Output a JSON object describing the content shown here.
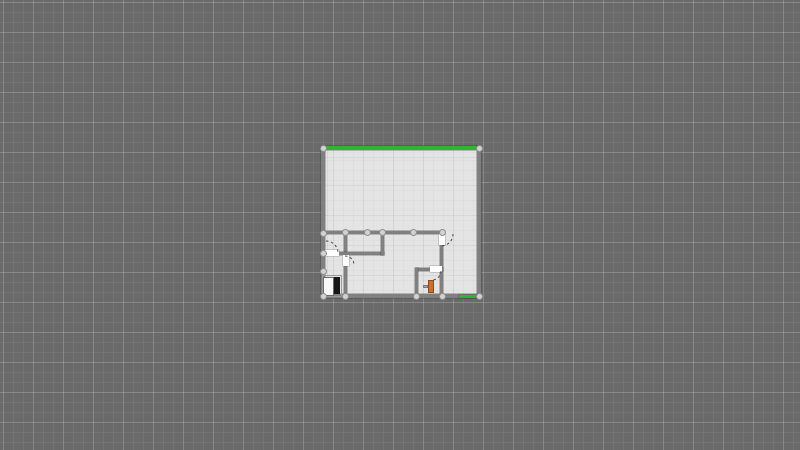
{
  "app": {
    "type": "floor-plan-editor-canvas",
    "visible_text": []
  },
  "colors": {
    "canvas_bg": "#6a6a6a",
    "floor": "#e4e4e4",
    "wall": "#808080",
    "selected_wall": "#2fb52f",
    "door": "#ffffff",
    "handle_fill": "#d2d2d2",
    "handle_edge": "#8f8f8f",
    "arc_stroke": "#4a4a4a",
    "furniture_black": "#161616",
    "furniture_white": "#f8f8f8",
    "furniture_orange": "#c5732c",
    "furniture_orange_edge": "#8a4a1a",
    "furniture_gray": "#a5a5a5"
  },
  "plan": {
    "floor": {
      "name": "room-floor",
      "x": 323,
      "y": 148,
      "w": 156,
      "h": 148
    },
    "walls": [
      {
        "name": "wall-top-selected",
        "x": 322,
        "y": 146,
        "w": 157,
        "h": 4,
        "color": "green"
      },
      {
        "name": "wall-left",
        "x": 321,
        "y": 146,
        "w": 4,
        "h": 152,
        "color": "gray"
      },
      {
        "name": "wall-right",
        "x": 477,
        "y": 146,
        "w": 4,
        "h": 152,
        "color": "gray"
      },
      {
        "name": "wall-bottom",
        "x": 321,
        "y": 294,
        "w": 158,
        "h": 4,
        "color": "gray"
      },
      {
        "name": "wall-bottom-right-selected",
        "x": 459,
        "y": 295,
        "w": 20,
        "h": 3,
        "color": "green"
      },
      {
        "name": "wall-middle-horizontal",
        "x": 323,
        "y": 231,
        "w": 120,
        "h": 3,
        "color": "gray"
      },
      {
        "name": "wall-vertical-left-rooms",
        "x": 344,
        "y": 231,
        "w": 3,
        "h": 66,
        "color": "gray"
      },
      {
        "name": "wall-horizontal-left-rooms",
        "x": 323,
        "y": 252,
        "w": 61,
        "h": 3,
        "color": "gray"
      },
      {
        "name": "wall-vertical-closet",
        "x": 381,
        "y": 231,
        "w": 3,
        "h": 24,
        "color": "gray"
      },
      {
        "name": "wall-vertical-right-room",
        "x": 440,
        "y": 231,
        "w": 3,
        "h": 66,
        "color": "gray"
      },
      {
        "name": "wall-bottom-room-top",
        "x": 416,
        "y": 268,
        "w": 27,
        "h": 3,
        "color": "gray"
      },
      {
        "name": "wall-bottom-room-left",
        "x": 415,
        "y": 268,
        "w": 3,
        "h": 29,
        "color": "gray"
      }
    ],
    "doors": [
      {
        "name": "door-opening-left-room",
        "x": 325,
        "y": 250,
        "w": 14,
        "h": 6
      },
      {
        "name": "door-opening-lower-left",
        "x": 343,
        "y": 255,
        "w": 6,
        "h": 11
      },
      {
        "name": "door-opening-hall",
        "x": 439,
        "y": 234,
        "w": 6,
        "h": 11
      },
      {
        "name": "door-opening-bottom-room",
        "x": 430,
        "y": 266,
        "w": 12,
        "h": 6
      }
    ],
    "door_arcs": [
      {
        "name": "door-swing-arc",
        "x1": 326,
        "y1": 241,
        "x2": 338,
        "y2": 253,
        "r": 12
      },
      {
        "name": "door-swing-arc",
        "x1": 345,
        "y1": 256,
        "x2": 354,
        "y2": 265,
        "r": 9
      },
      {
        "name": "door-swing-arc",
        "x1": 453,
        "y1": 234,
        "x2": 441,
        "y2": 246,
        "r": 12
      },
      {
        "name": "door-swing-arc",
        "x1": 441,
        "y1": 271,
        "x2": 432,
        "y2": 280,
        "r": 9
      }
    ],
    "handles": [
      {
        "x": 323,
        "y": 148
      },
      {
        "x": 479,
        "y": 148
      },
      {
        "x": 323,
        "y": 233
      },
      {
        "x": 323,
        "y": 253
      },
      {
        "x": 323,
        "y": 271
      },
      {
        "x": 323,
        "y": 296
      },
      {
        "x": 345,
        "y": 232
      },
      {
        "x": 367,
        "y": 232
      },
      {
        "x": 382,
        "y": 232
      },
      {
        "x": 413,
        "y": 232
      },
      {
        "x": 442,
        "y": 232
      },
      {
        "x": 345,
        "y": 296
      },
      {
        "x": 416,
        "y": 296
      },
      {
        "x": 442,
        "y": 296
      },
      {
        "x": 479,
        "y": 296
      }
    ],
    "furniture": [
      {
        "name": "furniture-cabinet-outline",
        "x": 322,
        "y": 275,
        "w": 20,
        "h": 22,
        "fill": "none",
        "edge": "#9a9a9a"
      },
      {
        "name": "furniture-cabinet-white-door",
        "x": 323,
        "y": 277,
        "w": 11,
        "h": 19,
        "fill": "#f8f8f8",
        "edge": "#6b6b6b"
      },
      {
        "name": "furniture-cabinet-black-panel",
        "x": 334,
        "y": 277,
        "w": 6,
        "h": 17,
        "fill": "#161616",
        "edge": "#161616"
      },
      {
        "name": "furniture-chair-body",
        "x": 428,
        "y": 280,
        "w": 6,
        "h": 13,
        "fill": "#c5732c",
        "edge": "#8a4a1a"
      },
      {
        "name": "furniture-chair-arm",
        "x": 423,
        "y": 285,
        "w": 5,
        "h": 3,
        "fill": "#a5a5a5",
        "edge": "#7a7a7a"
      }
    ]
  }
}
